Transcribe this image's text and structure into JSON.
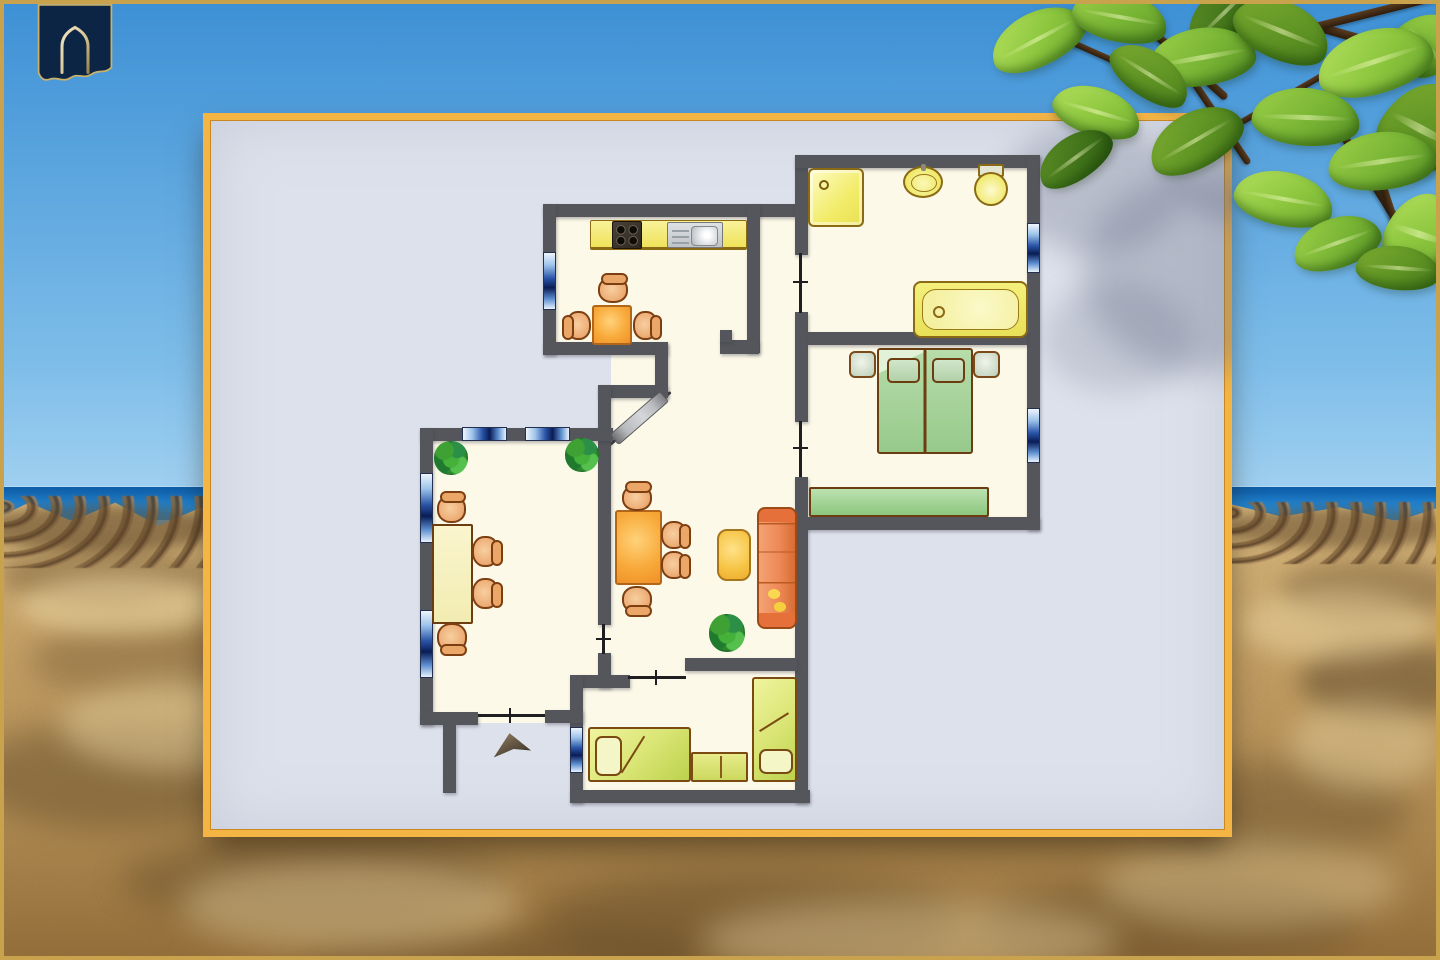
{
  "meta": {
    "description": "Holiday-apartment floor plan card displayed over a beach photo background",
    "visible_text": "none"
  },
  "palette": {
    "sky1": "#3d90d5",
    "sky2": "#7ebde9",
    "sky3": "#a8d4f2",
    "sand1": "#dabb80",
    "sand2": "#c9a468",
    "sand3": "#b08a50",
    "sand4": "#97703a",
    "wall": "#54565b",
    "floor": "#fcf9e8",
    "card": "#dde1eb",
    "cardgold": "#f5b544",
    "frame": "#c9a24e"
  },
  "background": {
    "sky": {
      "name": "blue-sky"
    },
    "ocean": {
      "name": "sea-horizon-band",
      "top": 486,
      "height": 34
    },
    "sand": {
      "name": "sandy-beach",
      "top": 498
    },
    "rock_strips": [
      {
        "x": -6,
        "y": 496,
        "w": 222,
        "h": 72
      },
      {
        "x": 1222,
        "y": 502,
        "w": 222,
        "h": 62
      }
    ],
    "blobs": [
      {
        "x": -20,
        "y": 505,
        "w": 240,
        "h": 46,
        "col": "#5a4226",
        "o": 0.55,
        "b": 6
      },
      {
        "x": 0,
        "y": 545,
        "w": 200,
        "h": 60,
        "col": "#5a4226",
        "o": 0.35,
        "b": 10
      },
      {
        "x": 30,
        "y": 620,
        "w": 240,
        "h": 80,
        "col": "#5a4226",
        "o": 0.3,
        "b": 14
      },
      {
        "x": -30,
        "y": 720,
        "w": 300,
        "h": 110,
        "col": "#4a3820",
        "o": 0.35,
        "b": 16
      },
      {
        "x": 120,
        "y": 835,
        "w": 380,
        "h": 90,
        "col": "#4a3820",
        "o": 0.3,
        "b": 16
      },
      {
        "x": 540,
        "y": 870,
        "w": 420,
        "h": 100,
        "col": "#4a3820",
        "o": 0.33,
        "b": 18
      },
      {
        "x": 980,
        "y": 880,
        "w": 380,
        "h": 90,
        "col": "#4a3820",
        "o": 0.3,
        "b": 16
      },
      {
        "x": 1225,
        "y": 508,
        "w": 230,
        "h": 40,
        "col": "#5a4226",
        "o": 0.5,
        "b": 6
      },
      {
        "x": 1280,
        "y": 560,
        "w": 180,
        "h": 60,
        "col": "#5a4226",
        "o": 0.35,
        "b": 10
      },
      {
        "x": 1300,
        "y": 640,
        "w": 170,
        "h": 80,
        "col": "#3e2f1a",
        "o": 0.4,
        "b": 12
      },
      {
        "x": 1150,
        "y": 760,
        "w": 260,
        "h": 100,
        "col": "#4a3820",
        "o": 0.3,
        "b": 16
      },
      {
        "x": 300,
        "y": 930,
        "w": 400,
        "h": 60,
        "col": "#4a3820",
        "o": 0.25,
        "b": 14
      },
      {
        "x": 20,
        "y": 575,
        "w": 200,
        "h": 60,
        "col": "#f0dca8",
        "o": 0.5,
        "b": 10
      },
      {
        "x": 60,
        "y": 680,
        "w": 240,
        "h": 90,
        "col": "#f0dca8",
        "o": 0.45,
        "b": 14
      },
      {
        "x": 180,
        "y": 860,
        "w": 340,
        "h": 90,
        "col": "#ecd9a8",
        "o": 0.4,
        "b": 16
      },
      {
        "x": 700,
        "y": 900,
        "w": 420,
        "h": 80,
        "col": "#ecd9a8",
        "o": 0.4,
        "b": 16
      },
      {
        "x": 1240,
        "y": 590,
        "w": 190,
        "h": 70,
        "col": "#f0dca8",
        "o": 0.45,
        "b": 12
      },
      {
        "x": 1290,
        "y": 700,
        "w": 150,
        "h": 90,
        "col": "#ecd9a8",
        "o": 0.4,
        "b": 14
      },
      {
        "x": 1100,
        "y": 840,
        "w": 300,
        "h": 90,
        "col": "#ecd9a8",
        "o": 0.35,
        "b": 16
      }
    ]
  },
  "logo": {
    "name": "navy-banner-with-gold-arch",
    "banner_color": "#0d2544",
    "outline_color": "#cbb169",
    "arch_color_light": "#f0e6c8",
    "arch_color_dark": "#9a8448"
  },
  "card": {
    "x": 203,
    "y": 113,
    "w": 1029,
    "h": 724,
    "leaf_shadows": [
      {
        "x": 800,
        "y": 10,
        "w": 180,
        "h": 130,
        "o": 0.28,
        "b": 14
      },
      {
        "x": 880,
        "y": 60,
        "w": 240,
        "h": 200,
        "o": 0.32,
        "b": 16
      },
      {
        "x": 960,
        "y": -10,
        "w": 160,
        "h": 120,
        "o": 0.3,
        "b": 12
      },
      {
        "x": 840,
        "y": 170,
        "w": 150,
        "h": 110,
        "o": 0.2,
        "b": 14
      }
    ]
  },
  "floorplan": {
    "rooms": [
      "kitchen",
      "bathroom",
      "bedroom",
      "living-room",
      "dining-room",
      "kids-room",
      "hallway"
    ],
    "floors": [
      [
        556,
        217,
        191,
        126
      ],
      [
        758,
        217,
        37,
        126
      ],
      [
        668,
        340,
        52,
        15
      ],
      [
        758,
        343,
        37,
        15
      ],
      [
        611,
        353,
        184,
        305
      ],
      [
        808,
        168,
        219,
        164
      ],
      [
        808,
        345,
        219,
        172
      ],
      [
        795,
        252,
        13,
        62
      ],
      [
        795,
        420,
        13,
        58
      ],
      [
        433,
        441,
        165,
        271
      ],
      [
        598,
        623,
        13,
        30
      ],
      [
        583,
        671,
        214,
        119
      ],
      [
        611,
        658,
        74,
        30
      ],
      [
        596,
        688,
        17,
        24
      ],
      [
        478,
        710,
        67,
        13
      ]
    ],
    "walls": [
      [
        543,
        204,
        265,
        13
      ],
      [
        795,
        155,
        13,
        100
      ],
      [
        795,
        155,
        245,
        13
      ],
      [
        1027,
        155,
        13,
        375
      ],
      [
        795,
        312,
        13,
        110
      ],
      [
        808,
        332,
        219,
        13
      ],
      [
        795,
        477,
        13,
        53
      ],
      [
        795,
        517,
        245,
        13
      ],
      [
        543,
        204,
        13,
        151
      ],
      [
        543,
        342,
        125,
        13
      ],
      [
        655,
        342,
        13,
        56
      ],
      [
        598,
        385,
        70,
        13
      ],
      [
        598,
        385,
        13,
        240
      ],
      [
        598,
        653,
        13,
        35
      ],
      [
        747,
        204,
        13,
        149
      ],
      [
        720,
        340,
        39,
        14
      ],
      [
        720,
        330,
        12,
        12
      ],
      [
        795,
        530,
        13,
        273
      ],
      [
        685,
        658,
        112,
        13
      ],
      [
        580,
        675,
        50,
        13
      ],
      [
        570,
        675,
        13,
        128
      ],
      [
        570,
        790,
        240,
        13
      ],
      [
        420,
        428,
        193,
        13
      ],
      [
        420,
        428,
        13,
        297
      ],
      [
        420,
        712,
        58,
        13
      ],
      [
        545,
        710,
        38,
        13
      ],
      [
        443,
        725,
        13,
        68
      ]
    ],
    "windows": [
      {
        "x": 543,
        "y": 252,
        "w": 13,
        "h": 58,
        "c": "v"
      },
      {
        "x": 462,
        "y": 427,
        "w": 45,
        "h": 14,
        "c": "h"
      },
      {
        "x": 525,
        "y": 427,
        "w": 45,
        "h": 14,
        "c": "h"
      },
      {
        "x": 420,
        "y": 473,
        "w": 13,
        "h": 70,
        "c": "v"
      },
      {
        "x": 420,
        "y": 610,
        "w": 13,
        "h": 68,
        "c": "v"
      },
      {
        "x": 570,
        "y": 727,
        "w": 13,
        "h": 46,
        "c": "v"
      },
      {
        "x": 1027,
        "y": 223,
        "w": 13,
        "h": 50,
        "c": "v"
      },
      {
        "x": 1027,
        "y": 408,
        "w": 13,
        "h": 55,
        "c": "v"
      }
    ],
    "doors": [
      {
        "x": 799,
        "y": 253,
        "w": 3,
        "h": 60,
        "c": "v"
      },
      {
        "x": 799,
        "y": 421,
        "w": 3,
        "h": 56,
        "c": "v"
      },
      {
        "x": 602,
        "y": 624,
        "w": 3,
        "h": 30,
        "c": "v"
      },
      {
        "x": 628,
        "y": 676,
        "w": 58,
        "h": 3,
        "c": "h"
      },
      {
        "x": 478,
        "y": 714,
        "w": 67,
        "h": 3,
        "c": "h"
      }
    ],
    "furniture": [
      {
        "t": "counter",
        "x": 590,
        "y": 220,
        "w": 157,
        "h": 30
      },
      {
        "t": "stove",
        "x": 612,
        "y": 221,
        "w": 30,
        "h": 28
      },
      {
        "t": "ksink",
        "x": 667,
        "y": 222,
        "w": 56,
        "h": 26
      },
      {
        "t": "table-orange",
        "x": 592,
        "y": 305,
        "w": 40,
        "h": 40
      },
      {
        "t": "chair n",
        "x": 598,
        "y": 277,
        "w": 30,
        "h": 26
      },
      {
        "t": "chair w",
        "x": 566,
        "y": 311,
        "w": 25,
        "h": 29
      },
      {
        "t": "chair e",
        "x": 633,
        "y": 311,
        "w": 25,
        "h": 29
      },
      {
        "t": "shower",
        "x": 808,
        "y": 168,
        "w": 56,
        "h": 59
      },
      {
        "t": "bsink",
        "x": 903,
        "y": 166,
        "w": 40,
        "h": 32
      },
      {
        "t": "toilet",
        "x": 974,
        "y": 164,
        "w": 30,
        "h": 40
      },
      {
        "t": "bathtub",
        "x": 913,
        "y": 281,
        "w": 115,
        "h": 57
      },
      {
        "t": "nightstand",
        "x": 849,
        "y": 351,
        "w": 27,
        "h": 27
      },
      {
        "t": "nightstand",
        "x": 973,
        "y": 351,
        "w": 27,
        "h": 27
      },
      {
        "t": "bed-double",
        "x": 877,
        "y": 348,
        "w": 96,
        "h": 106
      },
      {
        "t": "wardrobe",
        "x": 809,
        "y": 487,
        "w": 180,
        "h": 30
      },
      {
        "t": "shelf",
        "x": 614,
        "y": 433,
        "w": 67,
        "h": 14,
        "r": -41
      },
      {
        "t": "diag",
        "x": 608,
        "y": 445,
        "w": 83,
        "h": 3,
        "r": -41
      },
      {
        "t": "table-orange",
        "x": 615,
        "y": 510,
        "w": 47,
        "h": 75
      },
      {
        "t": "chair n",
        "x": 622,
        "y": 485,
        "w": 30,
        "h": 26
      },
      {
        "t": "chair e",
        "x": 661,
        "y": 521,
        "w": 26,
        "h": 28
      },
      {
        "t": "chair e",
        "x": 661,
        "y": 551,
        "w": 26,
        "h": 28
      },
      {
        "t": "chair s",
        "x": 622,
        "y": 586,
        "w": 30,
        "h": 27
      },
      {
        "t": "coffee-table",
        "x": 717,
        "y": 529,
        "w": 34,
        "h": 52
      },
      {
        "t": "sofa",
        "x": 757,
        "y": 507,
        "w": 40,
        "h": 122
      },
      {
        "t": "plant",
        "x": 709,
        "y": 614,
        "w": 36,
        "h": 38
      },
      {
        "t": "plant",
        "x": 434,
        "y": 441,
        "w": 34,
        "h": 34
      },
      {
        "t": "plant",
        "x": 565,
        "y": 438,
        "w": 34,
        "h": 34
      },
      {
        "t": "table-pale",
        "x": 432,
        "y": 524,
        "w": 41,
        "h": 100
      },
      {
        "t": "chair n",
        "x": 437,
        "y": 495,
        "w": 29,
        "h": 28
      },
      {
        "t": "chair e",
        "x": 472,
        "y": 536,
        "w": 27,
        "h": 31
      },
      {
        "t": "chair e",
        "x": 472,
        "y": 578,
        "w": 27,
        "h": 31
      },
      {
        "t": "chair s",
        "x": 437,
        "y": 623,
        "w": 30,
        "h": 29
      },
      {
        "t": "bed-h",
        "x": 588,
        "y": 727,
        "w": 103,
        "h": 55
      },
      {
        "t": "dresser",
        "x": 691,
        "y": 752,
        "w": 57,
        "h": 30
      },
      {
        "t": "bed-v",
        "x": 752,
        "y": 677,
        "w": 45,
        "h": 105
      },
      {
        "t": "arrow",
        "x": 492,
        "y": 733,
        "w": 38,
        "h": 22,
        "r": -8
      }
    ]
  },
  "tree": {
    "branches": [
      {
        "x": 1115,
        "y": -6,
        "w": 150,
        "h": 8,
        "r": 42
      },
      {
        "x": 1198,
        "y": -12,
        "w": 240,
        "h": 9,
        "r": 16
      },
      {
        "x": 1255,
        "y": 38,
        "w": 210,
        "h": 8,
        "r": -14
      },
      {
        "x": 1165,
        "y": 36,
        "w": 150,
        "h": 7,
        "r": 56
      },
      {
        "x": 1315,
        "y": 86,
        "w": 170,
        "h": 8,
        "r": 58
      },
      {
        "x": 1042,
        "y": 26,
        "w": 120,
        "h": 6,
        "r": 24
      },
      {
        "x": 1372,
        "y": 148,
        "w": 100,
        "h": 7,
        "r": 72
      },
      {
        "x": 1240,
        "y": 120,
        "w": 140,
        "h": 6,
        "r": -30
      }
    ],
    "leaves": [
      {
        "x": 988,
        "y": 12,
        "w": 100,
        "h": 54,
        "r": -24,
        "c": "b"
      },
      {
        "x": 1072,
        "y": -8,
        "w": 96,
        "h": 50,
        "r": 14,
        "c": "a"
      },
      {
        "x": 1180,
        "y": -12,
        "w": 90,
        "h": 48,
        "r": -40,
        "c": "d"
      },
      {
        "x": 1395,
        "y": 10,
        "w": 60,
        "h": 70,
        "r": 50,
        "c": "a"
      },
      {
        "x": 1148,
        "y": 28,
        "w": 108,
        "h": 58,
        "r": -6,
        "c": "a"
      },
      {
        "x": 1232,
        "y": 2,
        "w": 100,
        "h": 58,
        "r": 26,
        "c": "c"
      },
      {
        "x": 1316,
        "y": 30,
        "w": 118,
        "h": 64,
        "r": -14,
        "c": "b"
      },
      {
        "x": 1106,
        "y": 52,
        "w": 88,
        "h": 46,
        "r": 36,
        "c": "c"
      },
      {
        "x": 1382,
        "y": 80,
        "w": 78,
        "h": 98,
        "r": 32,
        "c": "c"
      },
      {
        "x": 1052,
        "y": 88,
        "w": 90,
        "h": 48,
        "r": 20,
        "c": "b"
      },
      {
        "x": 1252,
        "y": 88,
        "w": 108,
        "h": 58,
        "r": 6,
        "c": "a"
      },
      {
        "x": 1146,
        "y": 112,
        "w": 100,
        "h": 56,
        "r": -26,
        "c": "c"
      },
      {
        "x": 1034,
        "y": 136,
        "w": 82,
        "h": 44,
        "r": -32,
        "c": "d"
      },
      {
        "x": 1328,
        "y": 132,
        "w": 108,
        "h": 58,
        "r": -4,
        "c": "a"
      },
      {
        "x": 1234,
        "y": 172,
        "w": 100,
        "h": 54,
        "r": 14,
        "c": "b"
      },
      {
        "x": 1386,
        "y": 192,
        "w": 68,
        "h": 84,
        "r": 22,
        "c": "b"
      },
      {
        "x": 1292,
        "y": 218,
        "w": 90,
        "h": 50,
        "r": -16,
        "c": "a"
      },
      {
        "x": 1356,
        "y": 246,
        "w": 84,
        "h": 44,
        "r": 8,
        "c": "c"
      }
    ]
  }
}
